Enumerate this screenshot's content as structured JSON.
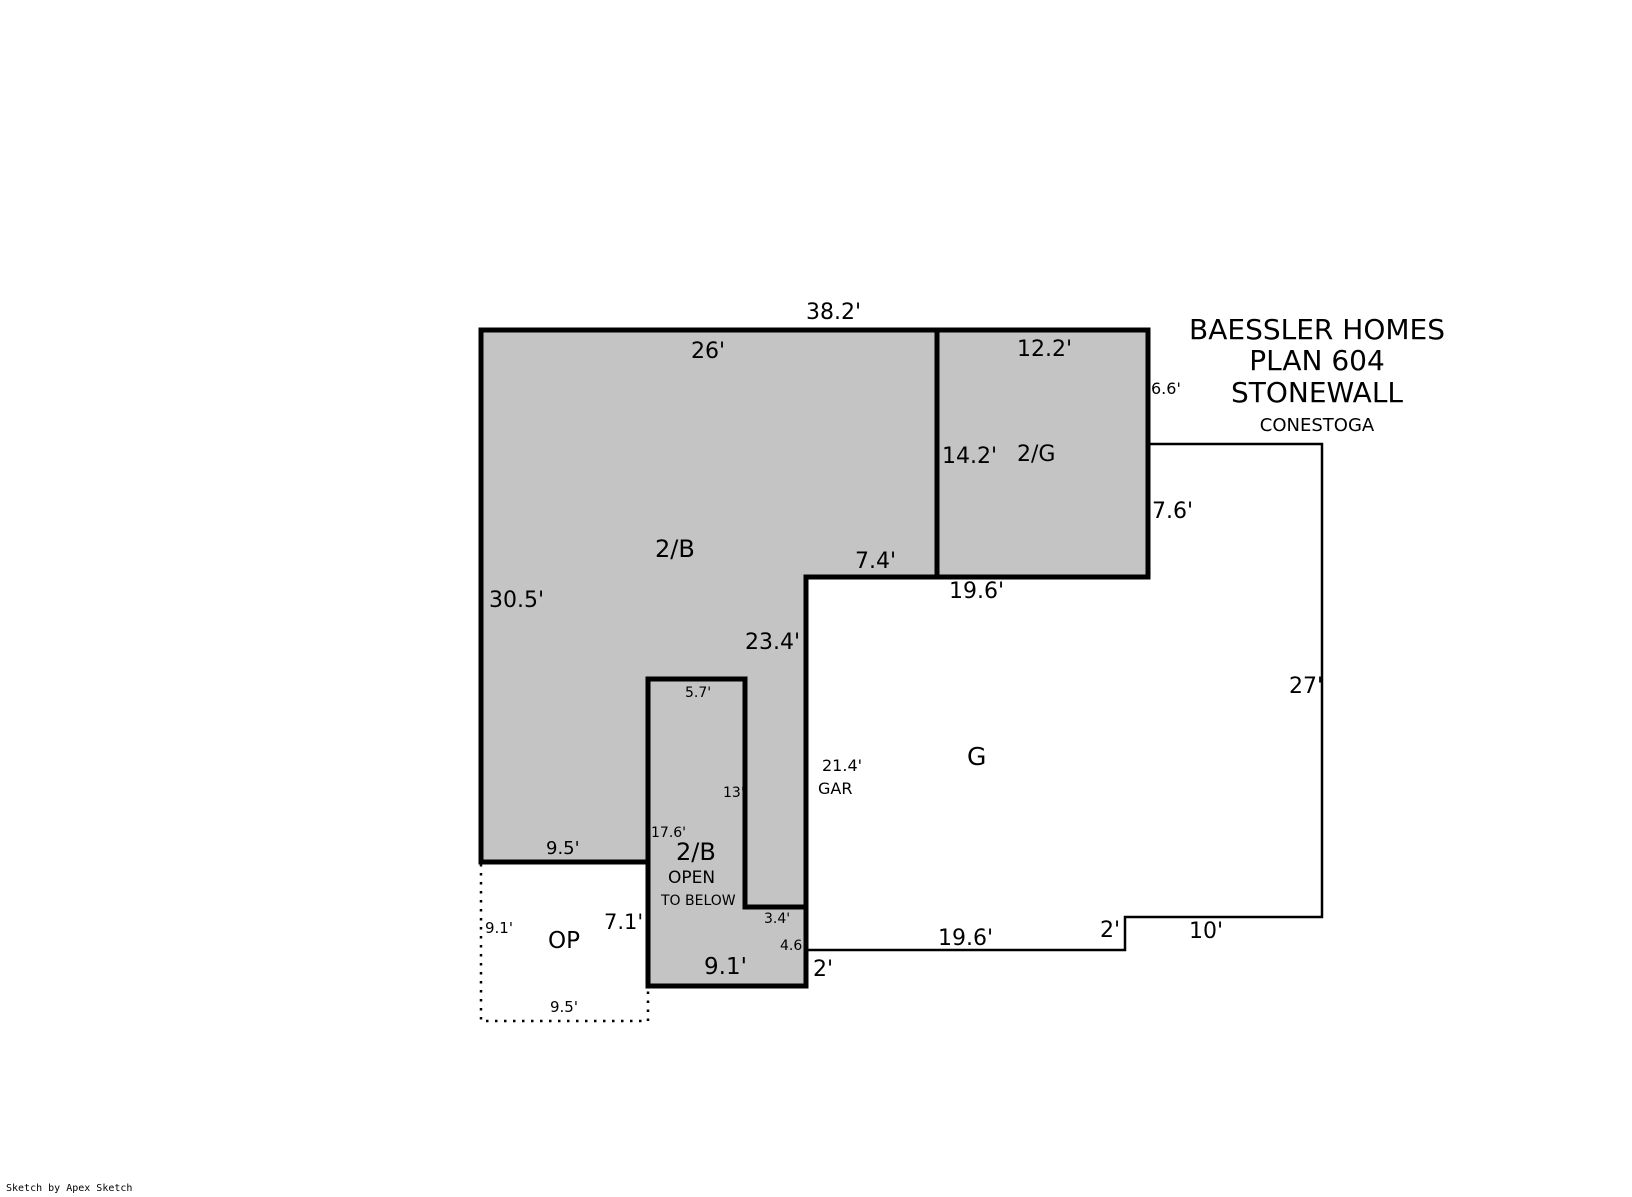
{
  "title_block": {
    "line1": "BAESSLER HOMES",
    "line2": "PLAN 604",
    "line3": "STONEWALL",
    "model": "CONESTOGA"
  },
  "watermark": "Sketch by Apex Sketch",
  "colors": {
    "area_fill": "#c4c4c4",
    "wall": "#000000",
    "background": "#ffffff"
  },
  "labels": {
    "top_width": "38.2'",
    "upper_2b_width": "26'",
    "upper_2g_width": "12.2'",
    "right_66": "6.6'",
    "g2_height": "14.2'",
    "room_2g": "2/G",
    "right_76": "7.6'",
    "room_2b_upper": "2/B",
    "left_height": "30.5'",
    "step_74": "7.4'",
    "garage_top_width": "19.6'",
    "garage_left_height": "23.4'",
    "right_height": "27'",
    "shaft_width": "5.7'",
    "shaft_height": "13'",
    "shaft_total_height": "17.6'",
    "room_2b_lower": "2/B",
    "open_word": "OPEN",
    "to_below": "TO BELOW",
    "garage_interior_height": "21.4'",
    "gar_abbrev": "GAR",
    "garage_letter": "G",
    "bottom_95_mid": "9.5'",
    "porch_left_height": "9.1'",
    "porch_label": "OP",
    "block_left_height": "7.1'",
    "step_34": "3.4'",
    "step_46": "4.6'",
    "block_bottom_width": "9.1'",
    "offset_2_left": "2'",
    "garage_bottom_width": "19.6'",
    "offset_2_right": "2'",
    "bottom_right_width": "10'",
    "porch_bottom_width": "9.5'"
  }
}
